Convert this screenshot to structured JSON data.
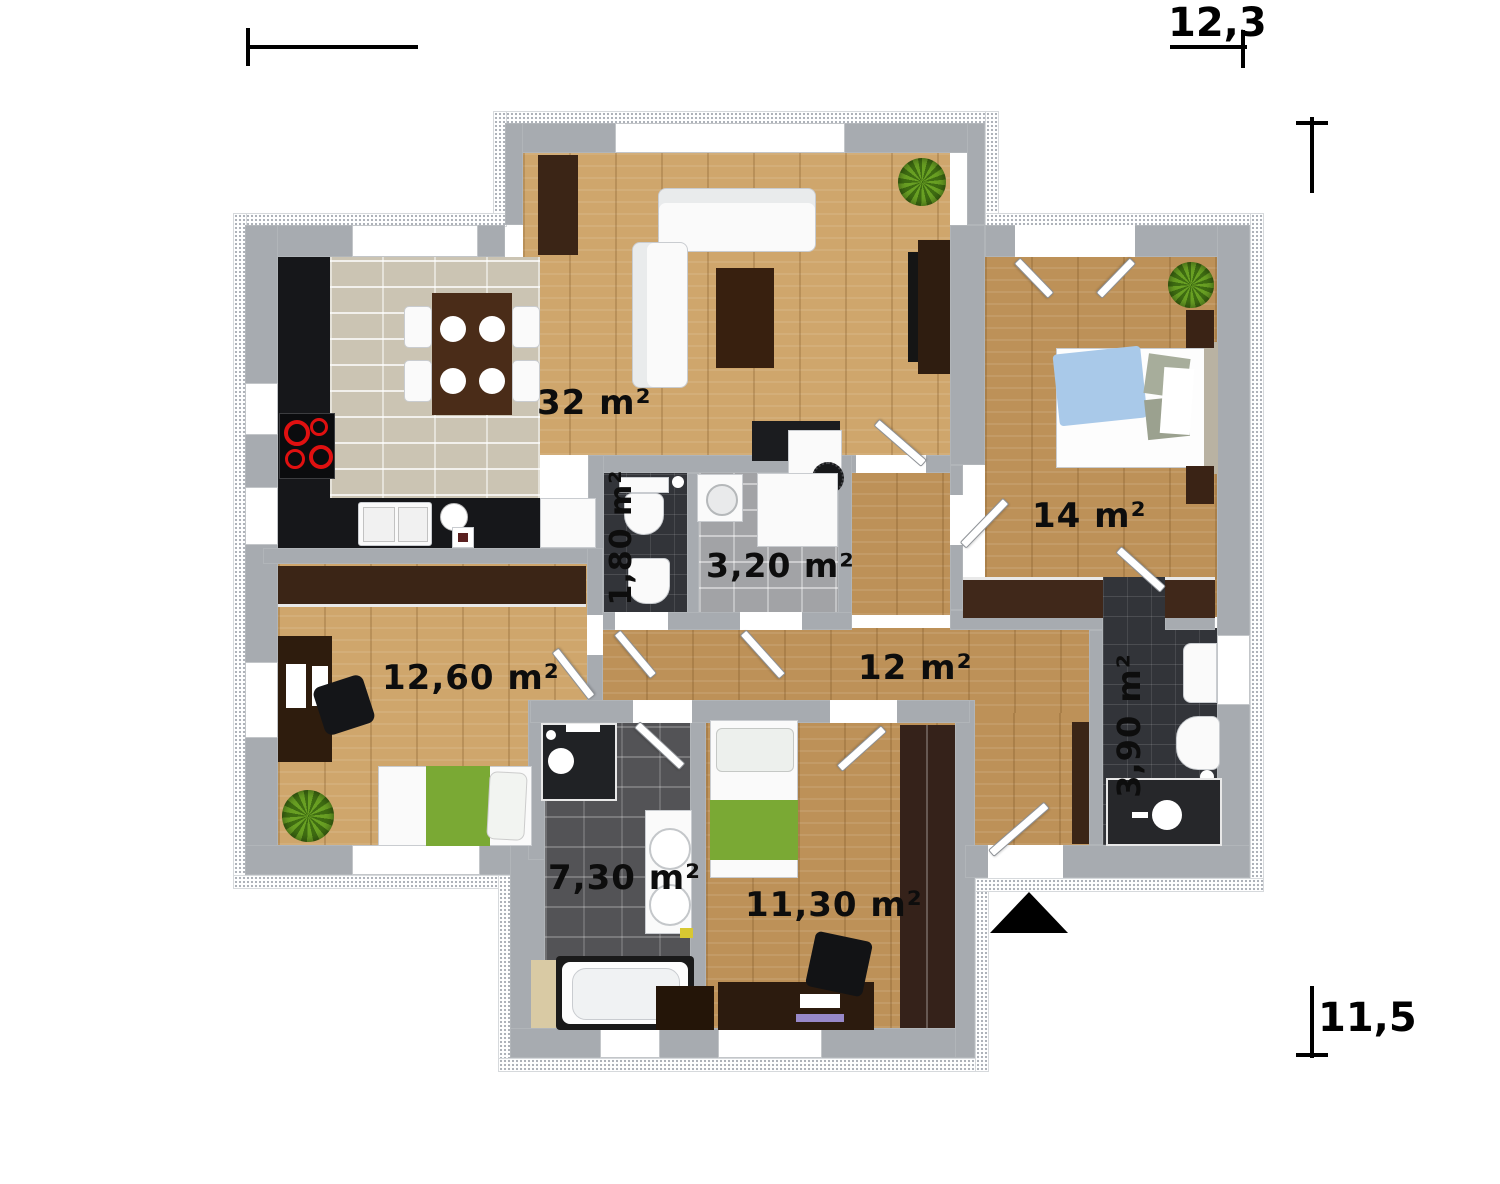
{
  "plan": {
    "rooms": [
      {
        "id": "living-kitchen",
        "label": "32 m²"
      },
      {
        "id": "bedroom-main",
        "label": "14 m²"
      },
      {
        "id": "wc",
        "label": "1,80 m²"
      },
      {
        "id": "utility",
        "label": "3,20 m²"
      },
      {
        "id": "hallway",
        "label": "12 m²"
      },
      {
        "id": "child-room",
        "label": "12,60 m²"
      },
      {
        "id": "bath-ensuite",
        "label": "3,90 m²"
      },
      {
        "id": "bathroom",
        "label": "7,30 m²"
      },
      {
        "id": "bedroom-second",
        "label": "11,30 m²"
      }
    ],
    "dimensions": {
      "width": "12,3",
      "height": "11,5"
    },
    "colors": {
      "wall": "#a7abb0",
      "wood": "#c8a067",
      "kitchen_tile": "#cbc4b3",
      "dark_tile": "#323439",
      "accent_green": "#7aa934",
      "accent_blue": "#a9c9e9",
      "burner_red": "#e01010",
      "label": "#0d0d0d"
    }
  }
}
